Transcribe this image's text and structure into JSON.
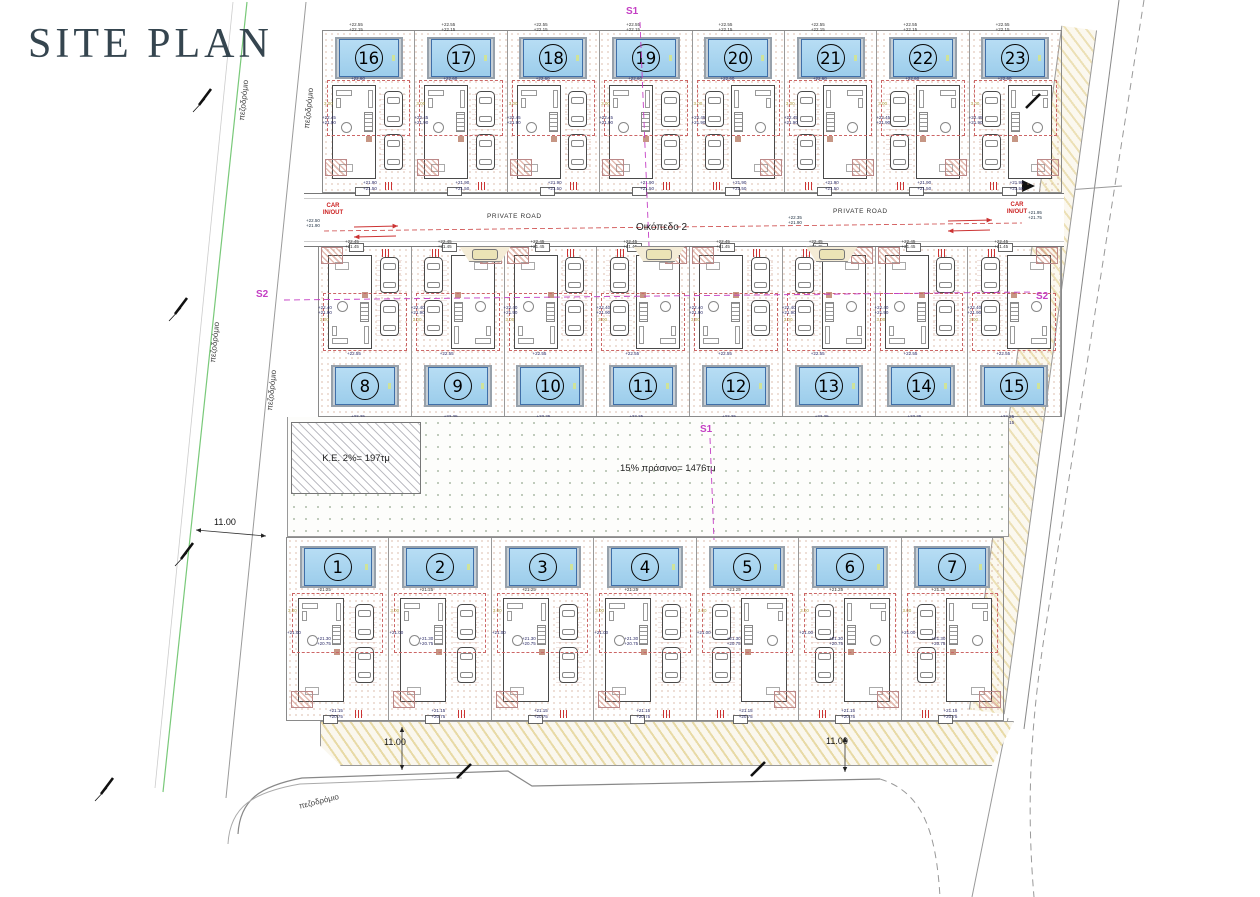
{
  "title": "SITE PLAN",
  "labels": {
    "s1": "S1",
    "s2": "S2",
    "private_road": "PRIVATE ROAD",
    "car_line1": "CAR",
    "car_line2": "IN/OUT",
    "oikopedo": "Οικόπεδο 2",
    "ke_area": "K.E. 2%= 197τμ",
    "green_area": "15% πράσινο= 1476τμ",
    "dim_11": "11.00",
    "sidewalk": "πεζοδρόμιο"
  },
  "rows": [
    {
      "id": "top",
      "plots": [
        {
          "num": 16,
          "mirror": false
        },
        {
          "num": 17,
          "mirror": false
        },
        {
          "num": 18,
          "mirror": false
        },
        {
          "num": 19,
          "mirror": false
        },
        {
          "num": 20,
          "mirror": true
        },
        {
          "num": 21,
          "mirror": true
        },
        {
          "num": 22,
          "mirror": true
        },
        {
          "num": 23,
          "mirror": true
        }
      ]
    },
    {
      "id": "mid",
      "plots": [
        {
          "num": 8,
          "mirror": false
        },
        {
          "num": 9,
          "mirror": true
        },
        {
          "num": 10,
          "mirror": false
        },
        {
          "num": 11,
          "mirror": true
        },
        {
          "num": 12,
          "mirror": false
        },
        {
          "num": 13,
          "mirror": true
        },
        {
          "num": 14,
          "mirror": false
        },
        {
          "num": 15,
          "mirror": true
        }
      ]
    },
    {
      "id": "bot",
      "plots": [
        {
          "num": 1,
          "mirror": false
        },
        {
          "num": 2,
          "mirror": false
        },
        {
          "num": 3,
          "mirror": false
        },
        {
          "num": 4,
          "mirror": false
        },
        {
          "num": 5,
          "mirror": true
        },
        {
          "num": 6,
          "mirror": true
        },
        {
          "num": 7,
          "mirror": true
        }
      ]
    }
  ],
  "elevations": {
    "top": {
      "e0": "+22.55\n+22.15",
      "e1": "+22.60",
      "e2": "+22.45\n+21.90",
      "e3": "+21.90\n+21.50"
    },
    "mid": {
      "e0": "+22.45\n+21.45",
      "e1": "+22.55",
      "e2": "+22.40\n+21.90",
      "e3": "+22.25\n+21.15"
    },
    "bot": {
      "e0": "+21.25",
      "e1": "+21.30\n+20.75",
      "e2": "+21.00",
      "e3": "+21.15\n+20.75"
    },
    "road": [
      "+22.50\n+21.90",
      "+22.35\n+21.90",
      "+21.95\n+21.75"
    ],
    "setback": "3.00"
  },
  "visitor_parking": {
    "positions": [
      140,
      314,
      487
    ]
  },
  "colors": {
    "title": "#35454f",
    "pool_fill": "#a9d6f0",
    "pool_edge": "#3f6fa8",
    "accent_red": "#cc3333",
    "accent_magenta": "#c43fc4",
    "boundary_green": "#79c979",
    "hatch_yellow": "#d6bd5f",
    "green_dot": "#7d9476"
  }
}
